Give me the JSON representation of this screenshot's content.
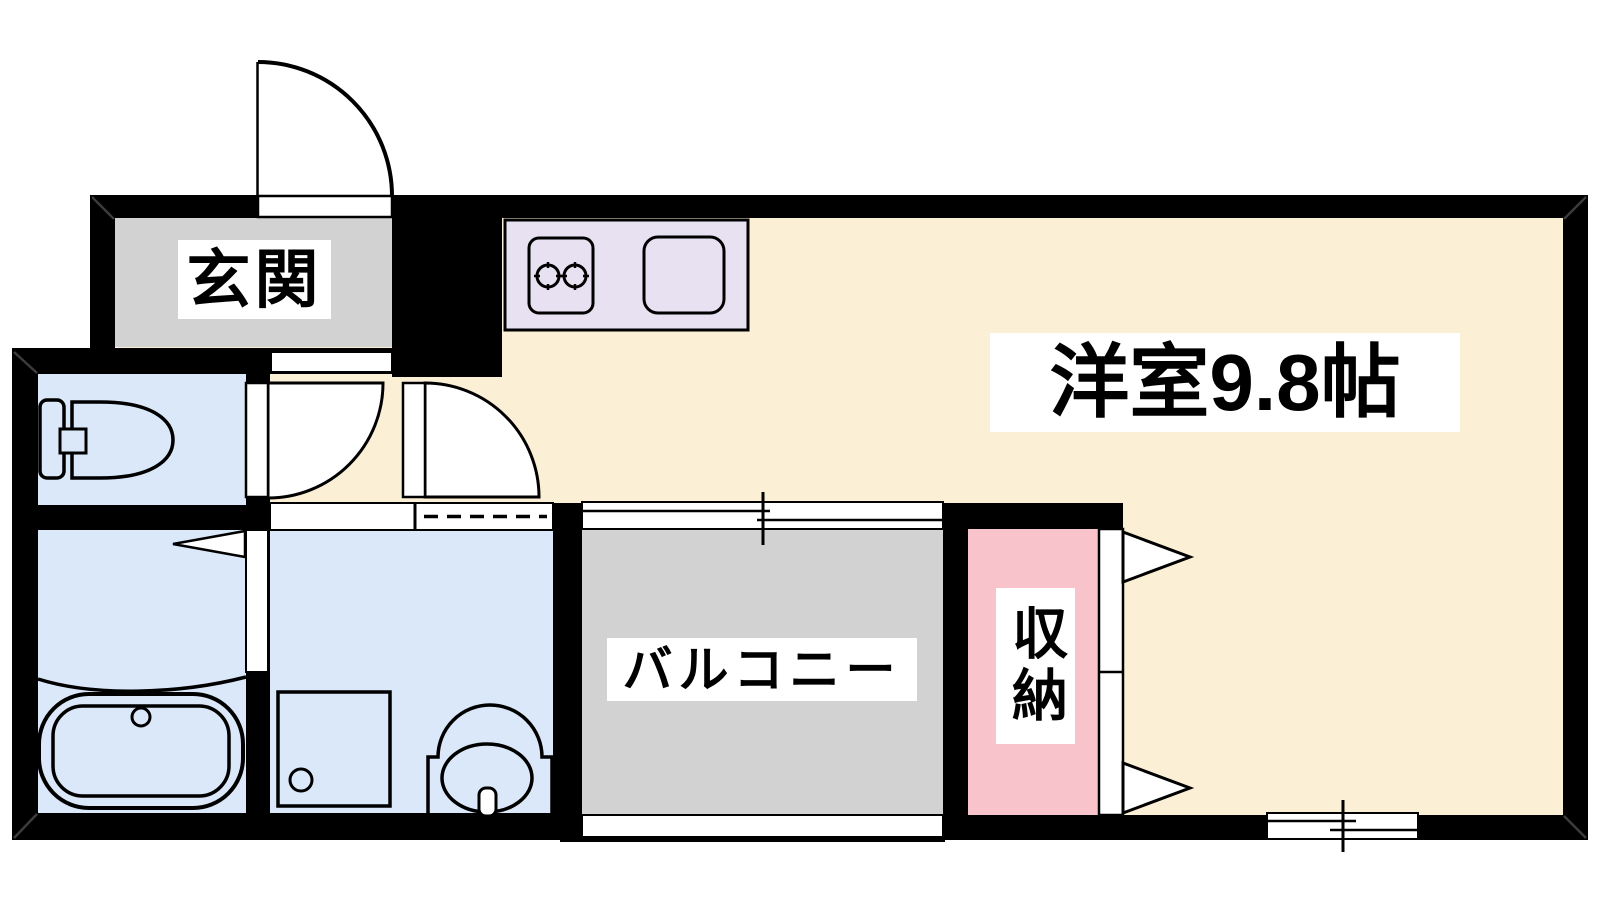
{
  "plan_title": "apartment floor plan",
  "colors": {
    "wall": "#000000",
    "outline": "#000000",
    "corner_miter": "#3c3c3c",
    "floor_main": "#FBEFD5",
    "floor_entrance": "#D2D2D2",
    "floor_wet": "#DAE8F9",
    "floor_kitchen": "#E8E1F2",
    "floor_balcony": "#D2D2D2",
    "floor_storage": "#F9C3CB",
    "door_fill": "#FFFFFF",
    "label_bg": "#FFFFFF",
    "label_text": "#000000"
  },
  "rooms": {
    "genkan": {
      "label": "玄関"
    },
    "main_room": {
      "label": "洋室9.8帖"
    },
    "balcony": {
      "label": "バルコニー"
    },
    "storage": {
      "label": "収納"
    }
  }
}
